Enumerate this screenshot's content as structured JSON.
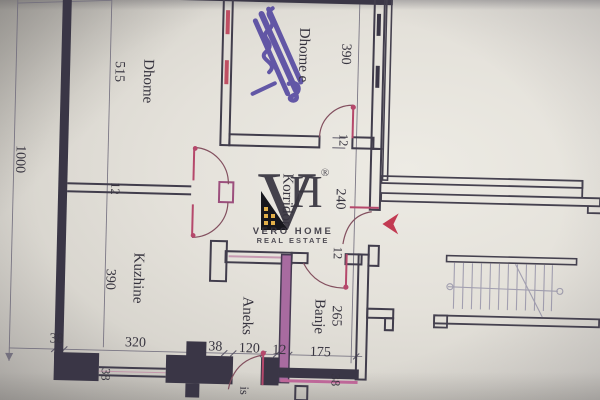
{
  "watermark": {
    "letter_v": "V",
    "letter_h": "H",
    "registered": "®",
    "line1": "VERO HOME",
    "line2": "REAL ESTATE",
    "gold": "#e2b04a"
  },
  "labels": {
    "overall_height": "1000",
    "room_left_name": "Dhome",
    "room_left_dim": "515",
    "room_top_name": "Dhome e",
    "room_top_dim": "390",
    "corridor_name": "Korridor",
    "corridor_dim": "240",
    "kitchen_name": "Kuzhine",
    "kitchen_dim": "390",
    "annex_name": "Aneks",
    "bath_name": "Banje",
    "bath_dim": "265",
    "wall12_top": "12",
    "wall12_mid": "12",
    "wall12_bath": "12",
    "wall12_inner": "12",
    "rot38_left": "38",
    "rot38_right": "38",
    "partial_text": "is"
  },
  "bottom_dims": [
    "38",
    "320",
    "38",
    "120",
    "12",
    "175"
  ],
  "colors": {
    "wall": "#3a3646",
    "pink_wall": "#a86ba0",
    "red_accent": "#b5486b",
    "arrow_red": "#c23a52",
    "ink_scribble": "#4c3f9d"
  }
}
